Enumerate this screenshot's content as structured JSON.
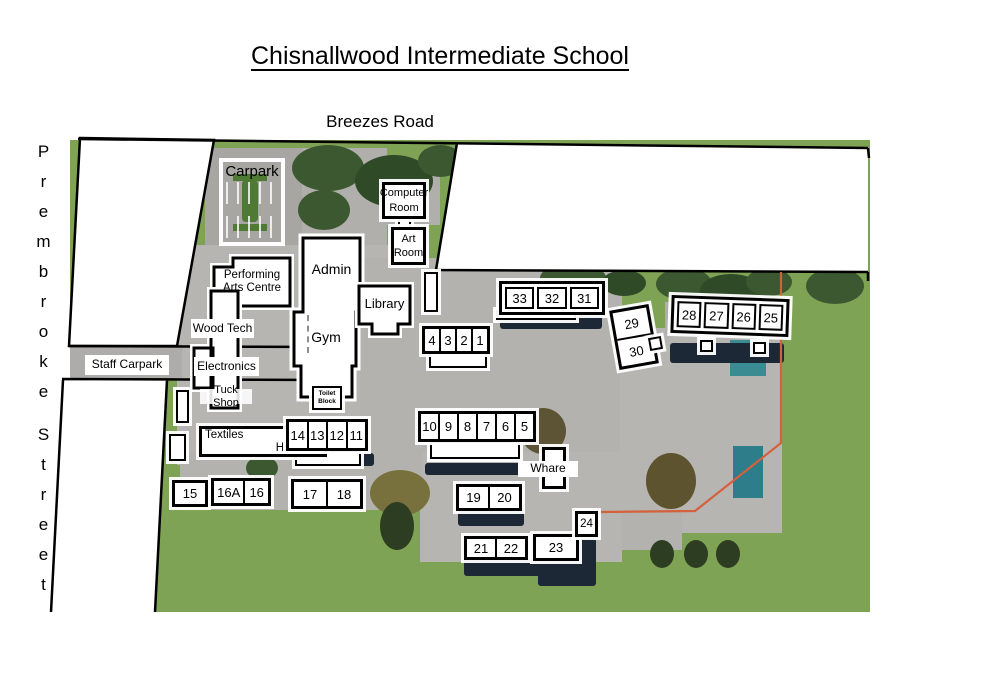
{
  "header": {
    "title": "Chisnallwood Intermediate School"
  },
  "roads": {
    "top": "Breezes Road",
    "left_line1": "Prembroke",
    "left_line2": "Street"
  },
  "buildings": {
    "carpark": "Carpark",
    "computer_room": "Computer Room",
    "art_room": "Art Room",
    "performing_arts": "Performing Arts Centre",
    "admin": "Admin",
    "gym": "Gym",
    "library": "Library",
    "wood_tech": "Wood Tech",
    "electronics": "Electronics",
    "tuck_shop": "Tuck Shop",
    "staff_carpark": "Staff Carpark",
    "toilet_block_line1": "Toilet",
    "toilet_block_line2": "Block",
    "textiles": "Textiles",
    "home_ec": "Home Ec",
    "whare": "Whare"
  },
  "blocks": {
    "b331": [
      "33",
      "32",
      "31"
    ],
    "b4321": [
      "4",
      "3",
      "2",
      "1"
    ],
    "b2930": [
      "29",
      "30"
    ],
    "b2825": [
      "28",
      "27",
      "26",
      "25"
    ],
    "b105": [
      "10",
      "9",
      "8",
      "7",
      "6",
      "5"
    ],
    "b1411": [
      "14",
      "13",
      "12",
      "11"
    ],
    "b15": [
      "15"
    ],
    "b16": [
      "16A",
      "16"
    ],
    "b1718": [
      "17",
      "18"
    ],
    "b1920": [
      "19",
      "20"
    ],
    "b2122": [
      "21",
      "22"
    ],
    "b23": [
      "23"
    ],
    "b24": [
      "24"
    ]
  },
  "colors": {
    "grass": "#7fa355",
    "pavement": "#b6b5b1",
    "tree": "#3c5831",
    "shadow": "#1d2837",
    "court": "#3a8b92",
    "property_line": "#d4603c",
    "boundary": "#000000"
  }
}
